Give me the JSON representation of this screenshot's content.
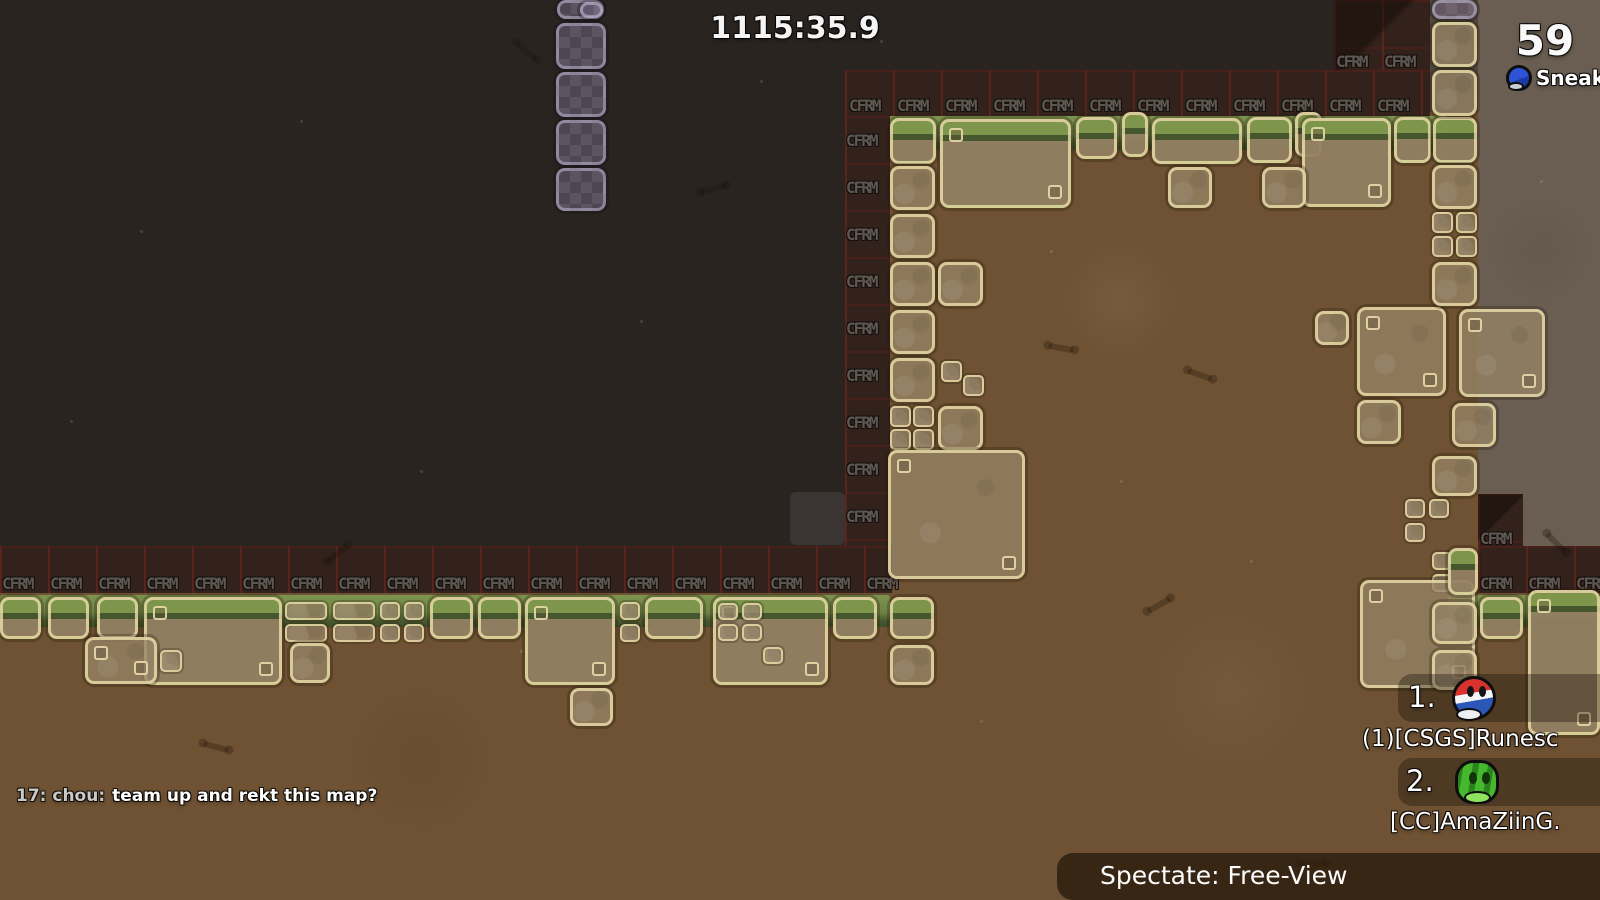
{
  "hud": {
    "timer": "1115:35.9",
    "score": "59",
    "spectated_player_name": "Sneaky Mum"
  },
  "chat": {
    "prefix": "17: chou:",
    "message": "team up and rekt this map?"
  },
  "leaderboard": {
    "entries": [
      {
        "rank": "1.",
        "name": "(1)[CSGS]Runesc",
        "avatar": "red-blue-tee"
      },
      {
        "rank": "2.",
        "name": "[CC]AmaZiinG.",
        "avatar": "green-cat-tee"
      }
    ]
  },
  "spectate_bar": {
    "label": "Spectate: Free-View"
  },
  "map": {
    "tile_marker_text": "CFRM",
    "colors": {
      "sky": "#2a2421",
      "dirt": "#6f5233",
      "outside": "#695e51",
      "band_background": "#33211b",
      "band_grid_line": "#58241c",
      "block_border": "#e9dda8",
      "grass": "#7d944e",
      "unhookable_purple": "#766886"
    },
    "regions": [
      [
        845,
        112,
        633,
        433,
        "dirt"
      ],
      [
        892,
        545,
        586,
        48,
        "dirt"
      ],
      [
        0,
        593,
        1600,
        307,
        "dirt"
      ],
      [
        1478,
        0,
        122,
        546,
        "outside"
      ],
      [
        1430,
        0,
        48,
        112,
        "wall"
      ]
    ],
    "grass_strips": [
      [
        0,
        595,
        890,
        32
      ],
      [
        1448,
        595,
        152,
        32
      ],
      [
        888,
        116,
        560,
        34
      ]
    ],
    "bands": [
      {
        "rect": [
          0,
          546,
          892,
          47
        ],
        "labels": {
          "start": [
            2,
            574
          ],
          "step": [
            48,
            0
          ],
          "count": 19
        }
      },
      {
        "rect": [
          1478,
          546,
          122,
          47
        ],
        "labels": {
          "start": [
            1480,
            574
          ],
          "step": [
            48,
            0
          ],
          "count": 3
        }
      },
      {
        "rect": [
          845,
          70,
          585,
          46
        ],
        "labels": {
          "start": [
            849,
            96
          ],
          "step": [
            48,
            0
          ],
          "count": 12
        }
      },
      {
        "rect": [
          845,
          116,
          45,
          430
        ],
        "labels": {
          "start": [
            846,
            131
          ],
          "step": [
            0,
            47
          ],
          "count": 9
        }
      },
      {
        "rect": [
          1334,
          0,
          96,
          70
        ],
        "labels": {
          "start": [
            1336,
            52
          ],
          "step": [
            48,
            0
          ],
          "count": 2
        },
        "diag": true
      },
      {
        "rect": [
          1478,
          494,
          45,
          52
        ],
        "labels": {
          "start": [
            1480,
            529
          ],
          "step": [
            48,
            0
          ],
          "count": 1
        },
        "diag": true
      }
    ],
    "blocks": [
      [
        557,
        0,
        47,
        19,
        "p"
      ],
      [
        580,
        2,
        23,
        16,
        "p"
      ],
      [
        556,
        23,
        50,
        46,
        "p"
      ],
      [
        556,
        72,
        50,
        45,
        "p"
      ],
      [
        556,
        120,
        50,
        45,
        "p"
      ],
      [
        556,
        168,
        50,
        43,
        "p"
      ],
      [
        1432,
        0,
        45,
        19,
        "p"
      ],
      [
        890,
        118,
        46,
        46,
        "g"
      ],
      [
        940,
        119,
        131,
        89,
        "g2"
      ],
      [
        1076,
        117,
        41,
        42,
        "g"
      ],
      [
        1122,
        112,
        26,
        45,
        "g"
      ],
      [
        1152,
        118,
        90,
        46,
        "g"
      ],
      [
        1247,
        117,
        45,
        46,
        "g"
      ],
      [
        1295,
        112,
        27,
        45,
        "g"
      ],
      [
        1302,
        118,
        89,
        89,
        "g2"
      ],
      [
        1394,
        117,
        37,
        46,
        "g"
      ],
      [
        1433,
        117,
        44,
        46,
        "g"
      ],
      [
        1168,
        167,
        44,
        41,
        "d"
      ],
      [
        1262,
        167,
        44,
        41,
        "d"
      ],
      [
        890,
        166,
        45,
        44,
        "d"
      ],
      [
        890,
        214,
        45,
        44,
        "d"
      ],
      [
        890,
        262,
        45,
        44,
        "d"
      ],
      [
        938,
        262,
        45,
        44,
        "d"
      ],
      [
        890,
        310,
        45,
        44,
        "d"
      ],
      [
        890,
        358,
        45,
        44,
        "d"
      ],
      [
        941,
        361,
        21,
        21,
        "s"
      ],
      [
        963,
        375,
        21,
        21,
        "s"
      ],
      [
        890,
        406,
        21,
        21,
        "s"
      ],
      [
        913,
        406,
        21,
        21,
        "s"
      ],
      [
        890,
        429,
        21,
        21,
        "s"
      ],
      [
        913,
        429,
        21,
        21,
        "s"
      ],
      [
        938,
        406,
        45,
        44,
        "d"
      ],
      [
        888,
        450,
        137,
        129,
        "d2"
      ],
      [
        1315,
        311,
        34,
        34,
        "d"
      ],
      [
        1357,
        307,
        89,
        89,
        "d2"
      ],
      [
        1459,
        309,
        86,
        88,
        "d2"
      ],
      [
        1357,
        400,
        44,
        44,
        "d"
      ],
      [
        1452,
        403,
        44,
        44,
        "d"
      ],
      [
        1432,
        456,
        45,
        40,
        "d"
      ],
      [
        1405,
        499,
        20,
        19,
        "s"
      ],
      [
        1429,
        499,
        20,
        19,
        "s"
      ],
      [
        1405,
        523,
        20,
        19,
        "s"
      ],
      [
        1432,
        552,
        20,
        18,
        "s"
      ],
      [
        1432,
        574,
        20,
        18,
        "s"
      ],
      [
        1432,
        22,
        45,
        45,
        "d"
      ],
      [
        1432,
        70,
        45,
        46,
        "d"
      ],
      [
        1432,
        165,
        45,
        44,
        "d"
      ],
      [
        1432,
        212,
        21,
        21,
        "s"
      ],
      [
        1456,
        212,
        21,
        21,
        "s"
      ],
      [
        1432,
        236,
        21,
        21,
        "s"
      ],
      [
        1456,
        236,
        21,
        21,
        "s"
      ],
      [
        1432,
        262,
        45,
        44,
        "d"
      ],
      [
        0,
        597,
        41,
        42,
        "g"
      ],
      [
        48,
        597,
        41,
        42,
        "g"
      ],
      [
        97,
        597,
        41,
        42,
        "g"
      ],
      [
        144,
        597,
        138,
        88,
        "g2"
      ],
      [
        85,
        637,
        72,
        47,
        "d2"
      ],
      [
        160,
        650,
        22,
        22,
        "s"
      ],
      [
        285,
        602,
        42,
        18,
        "s"
      ],
      [
        285,
        624,
        42,
        18,
        "s"
      ],
      [
        333,
        602,
        42,
        18,
        "s"
      ],
      [
        333,
        624,
        42,
        18,
        "s"
      ],
      [
        380,
        602,
        20,
        18,
        "s"
      ],
      [
        404,
        602,
        20,
        18,
        "s"
      ],
      [
        380,
        624,
        20,
        18,
        "s"
      ],
      [
        404,
        624,
        20,
        18,
        "s"
      ],
      [
        290,
        643,
        40,
        40,
        "d"
      ],
      [
        430,
        597,
        43,
        42,
        "g"
      ],
      [
        478,
        597,
        43,
        42,
        "g"
      ],
      [
        525,
        597,
        90,
        88,
        "g2"
      ],
      [
        570,
        688,
        43,
        38,
        "d"
      ],
      [
        620,
        602,
        20,
        18,
        "s"
      ],
      [
        620,
        624,
        20,
        18,
        "s"
      ],
      [
        645,
        597,
        58,
        42,
        "g"
      ],
      [
        713,
        597,
        115,
        88,
        "g2"
      ],
      [
        718,
        603,
        20,
        17,
        "s"
      ],
      [
        742,
        603,
        20,
        17,
        "s"
      ],
      [
        718,
        624,
        20,
        17,
        "s"
      ],
      [
        742,
        624,
        20,
        17,
        "s"
      ],
      [
        763,
        647,
        20,
        17,
        "s"
      ],
      [
        833,
        597,
        44,
        42,
        "g"
      ],
      [
        890,
        597,
        44,
        42,
        "g"
      ],
      [
        890,
        645,
        44,
        40,
        "d"
      ],
      [
        1360,
        580,
        115,
        108,
        "d2"
      ],
      [
        1432,
        602,
        45,
        42,
        "d"
      ],
      [
        1432,
        650,
        45,
        40,
        "d"
      ],
      [
        1448,
        548,
        30,
        47,
        "g"
      ],
      [
        1480,
        597,
        43,
        42,
        "g"
      ],
      [
        1528,
        590,
        72,
        145,
        "g2"
      ],
      [
        790,
        492,
        55,
        53,
        "gh"
      ]
    ],
    "specks": [
      [
        140,
        230
      ],
      [
        300,
        120
      ],
      [
        640,
        320
      ],
      [
        420,
        470
      ],
      [
        1050,
        250
      ],
      [
        760,
        80
      ],
      [
        1120,
        480
      ],
      [
        520,
        650
      ],
      [
        980,
        720
      ],
      [
        1250,
        560
      ],
      [
        180,
        640
      ],
      [
        1540,
        180
      ],
      [
        1500,
        320
      ],
      [
        70,
        420
      ],
      [
        880,
        40
      ]
    ],
    "bones": [
      {
        "x": 513,
        "y": 48,
        "r": 40
      },
      {
        "x": 700,
        "y": 186,
        "r": -15
      },
      {
        "x": 1048,
        "y": 345,
        "r": 10
      },
      {
        "x": 1187,
        "y": 372,
        "r": 20
      },
      {
        "x": 1146,
        "y": 602,
        "r": -30
      },
      {
        "x": 203,
        "y": 744,
        "r": 15
      },
      {
        "x": 1300,
        "y": 860,
        "r": 0
      },
      {
        "x": 1543,
        "y": 540,
        "r": 45
      },
      {
        "x": 325,
        "y": 550,
        "r": -40
      }
    ]
  }
}
